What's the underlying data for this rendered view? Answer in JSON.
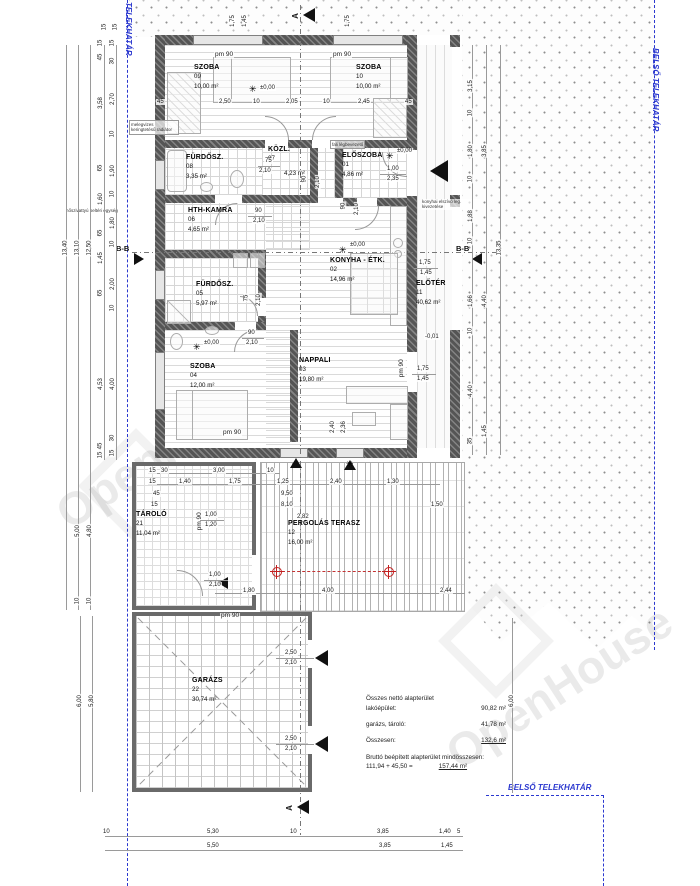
{
  "boundary": {
    "left_label": "TELEKHATÁR",
    "right_label": "BELSŐ TELEKHATÁR",
    "bottom_label": "BELSŐ TELEKHATÁR"
  },
  "watermark": "OpenHouse",
  "rooms": {
    "szoba09": {
      "name": "SZOBA",
      "num": "09",
      "area": "10,00 m²"
    },
    "szoba10": {
      "name": "SZOBA",
      "num": "10",
      "area": "10,00 m²"
    },
    "furdo08": {
      "name": "FÜRDŐSZ.",
      "num": "08",
      "area": "3,35 m²"
    },
    "kozl": {
      "name": "KÖZL.",
      "num": "07",
      "area": "4,23 m²"
    },
    "eloszoba": {
      "name": "ELŐSZOBA",
      "num": "01",
      "area": "4,86 m²"
    },
    "kamra": {
      "name": "HTH-KAMRA",
      "num": "06",
      "area": "4,65 m²"
    },
    "furdo05": {
      "name": "FÜRDŐSZ.",
      "num": "05",
      "area": "5,97 m²"
    },
    "konyha": {
      "name": "KONYHA - ÉTK.",
      "num": "02",
      "area": "14,96 m²"
    },
    "eloter": {
      "name": "ELŐTÉR",
      "num": "11",
      "area": "40,62 m²"
    },
    "szoba04": {
      "name": "SZOBA",
      "num": "04",
      "area": "12,00 m²"
    },
    "nappali": {
      "name": "NAPPALI",
      "num": "03",
      "area": "19,80 m²"
    },
    "tarolo": {
      "name": "TÁROLÓ",
      "num": "21",
      "area": "11,04 m²"
    },
    "terasz": {
      "name": "PERGOLÁS TERASZ",
      "num": "12",
      "area": "16,00 m²"
    },
    "garazs": {
      "name": "GARÁZS",
      "num": "22",
      "area": "30,74 m²"
    }
  },
  "levels": {
    "zero": "±0,00",
    "minus": "-0,01",
    "flower": "✳"
  },
  "pm90": "pm 90",
  "sections": {
    "a": "A",
    "bb": "B-B"
  },
  "annotations": {
    "heatpump": "hőszivattyú beltéri egység",
    "radiator": "melegvizes keringtetésű radiátor",
    "airin": "fali légbevezető",
    "vent": "konyhai elszívó leg. kivezetése"
  },
  "summary": {
    "line1": "Összes nettó alapterület",
    "l2": "lakóépület:",
    "v2": "90,82 m²",
    "l3": "garázs, tároló:",
    "v3": "41,78 m²",
    "l4": "Összesen:",
    "v4": "132,6 m²",
    "line5": "Bruttó beépített alapterület mindösszesen:",
    "l6": "111,94 + 45,50 =",
    "v6": "157,44 m²"
  },
  "dims": {
    "totL": [
      "13,40",
      "13,10",
      "12,50"
    ],
    "leftA": [
      "15",
      "45",
      "3,58",
      "65",
      "1,60",
      "65",
      "1,45",
      "65",
      "4,53",
      "45",
      "15"
    ],
    "leftB": [
      "15",
      "30",
      "2,70",
      "10",
      "1,90",
      "10",
      "1,80",
      "10",
      "2,00",
      "10",
      "4,00",
      "30",
      "15"
    ],
    "leftLow": [
      "5,00",
      "4,80",
      "10",
      "10",
      "6,00",
      "5,80"
    ],
    "topRow": [
      "45",
      "2,50",
      "10",
      "2,05",
      "10",
      "2,45",
      "45"
    ],
    "topV": [
      "15",
      "15",
      "1,75",
      "1,45",
      "1,75"
    ],
    "bottom1": [
      "10",
      "5,30",
      "10",
      "3,85",
      "1,40",
      "5"
    ],
    "bottom2": [
      "5,50",
      "3,85",
      "1,45"
    ],
    "right1": [
      "3,15",
      "10",
      "1,80",
      "10",
      "1,88",
      "10",
      "1,66",
      "10",
      "4,40",
      "35"
    ],
    "right2": [
      "3,85",
      "4,40",
      "1,45",
      "13,35"
    ],
    "right3": [
      "6,00"
    ],
    "ter1": [
      "15",
      "30",
      "3,00",
      "10"
    ],
    "ter2": [
      "15",
      "1,40",
      "1,75",
      "1,25",
      "2,40",
      "1,30"
    ],
    "ter3": [
      "45",
      "15",
      "9,50",
      "8,10",
      "2,82",
      "1,50"
    ],
    "ter4": [
      "1,80",
      "4,00",
      "2,44"
    ],
    "pairs": {
      "kozl": [
        "75",
        "2,10"
      ],
      "eloszoba": [
        "1,00",
        "2,35"
      ],
      "kamra": [
        "90",
        "2,10"
      ],
      "furdo05": [
        "75",
        "2,10"
      ],
      "szoba04": [
        "90",
        "2,10"
      ],
      "kozl2": [
        "90",
        "2,10"
      ],
      "elosz2": [
        "90",
        "2,10"
      ],
      "eloter": [
        "1,75",
        "1,45"
      ],
      "nappaliV": [
        "2,40",
        "2,36"
      ],
      "nappaliR": [
        "1,75",
        "1,45"
      ],
      "tarolo1": [
        "1,00",
        "1,20"
      ],
      "tarolo2": [
        "1,00",
        "2,10"
      ],
      "garazs": [
        "2,50",
        "2,10"
      ]
    }
  }
}
